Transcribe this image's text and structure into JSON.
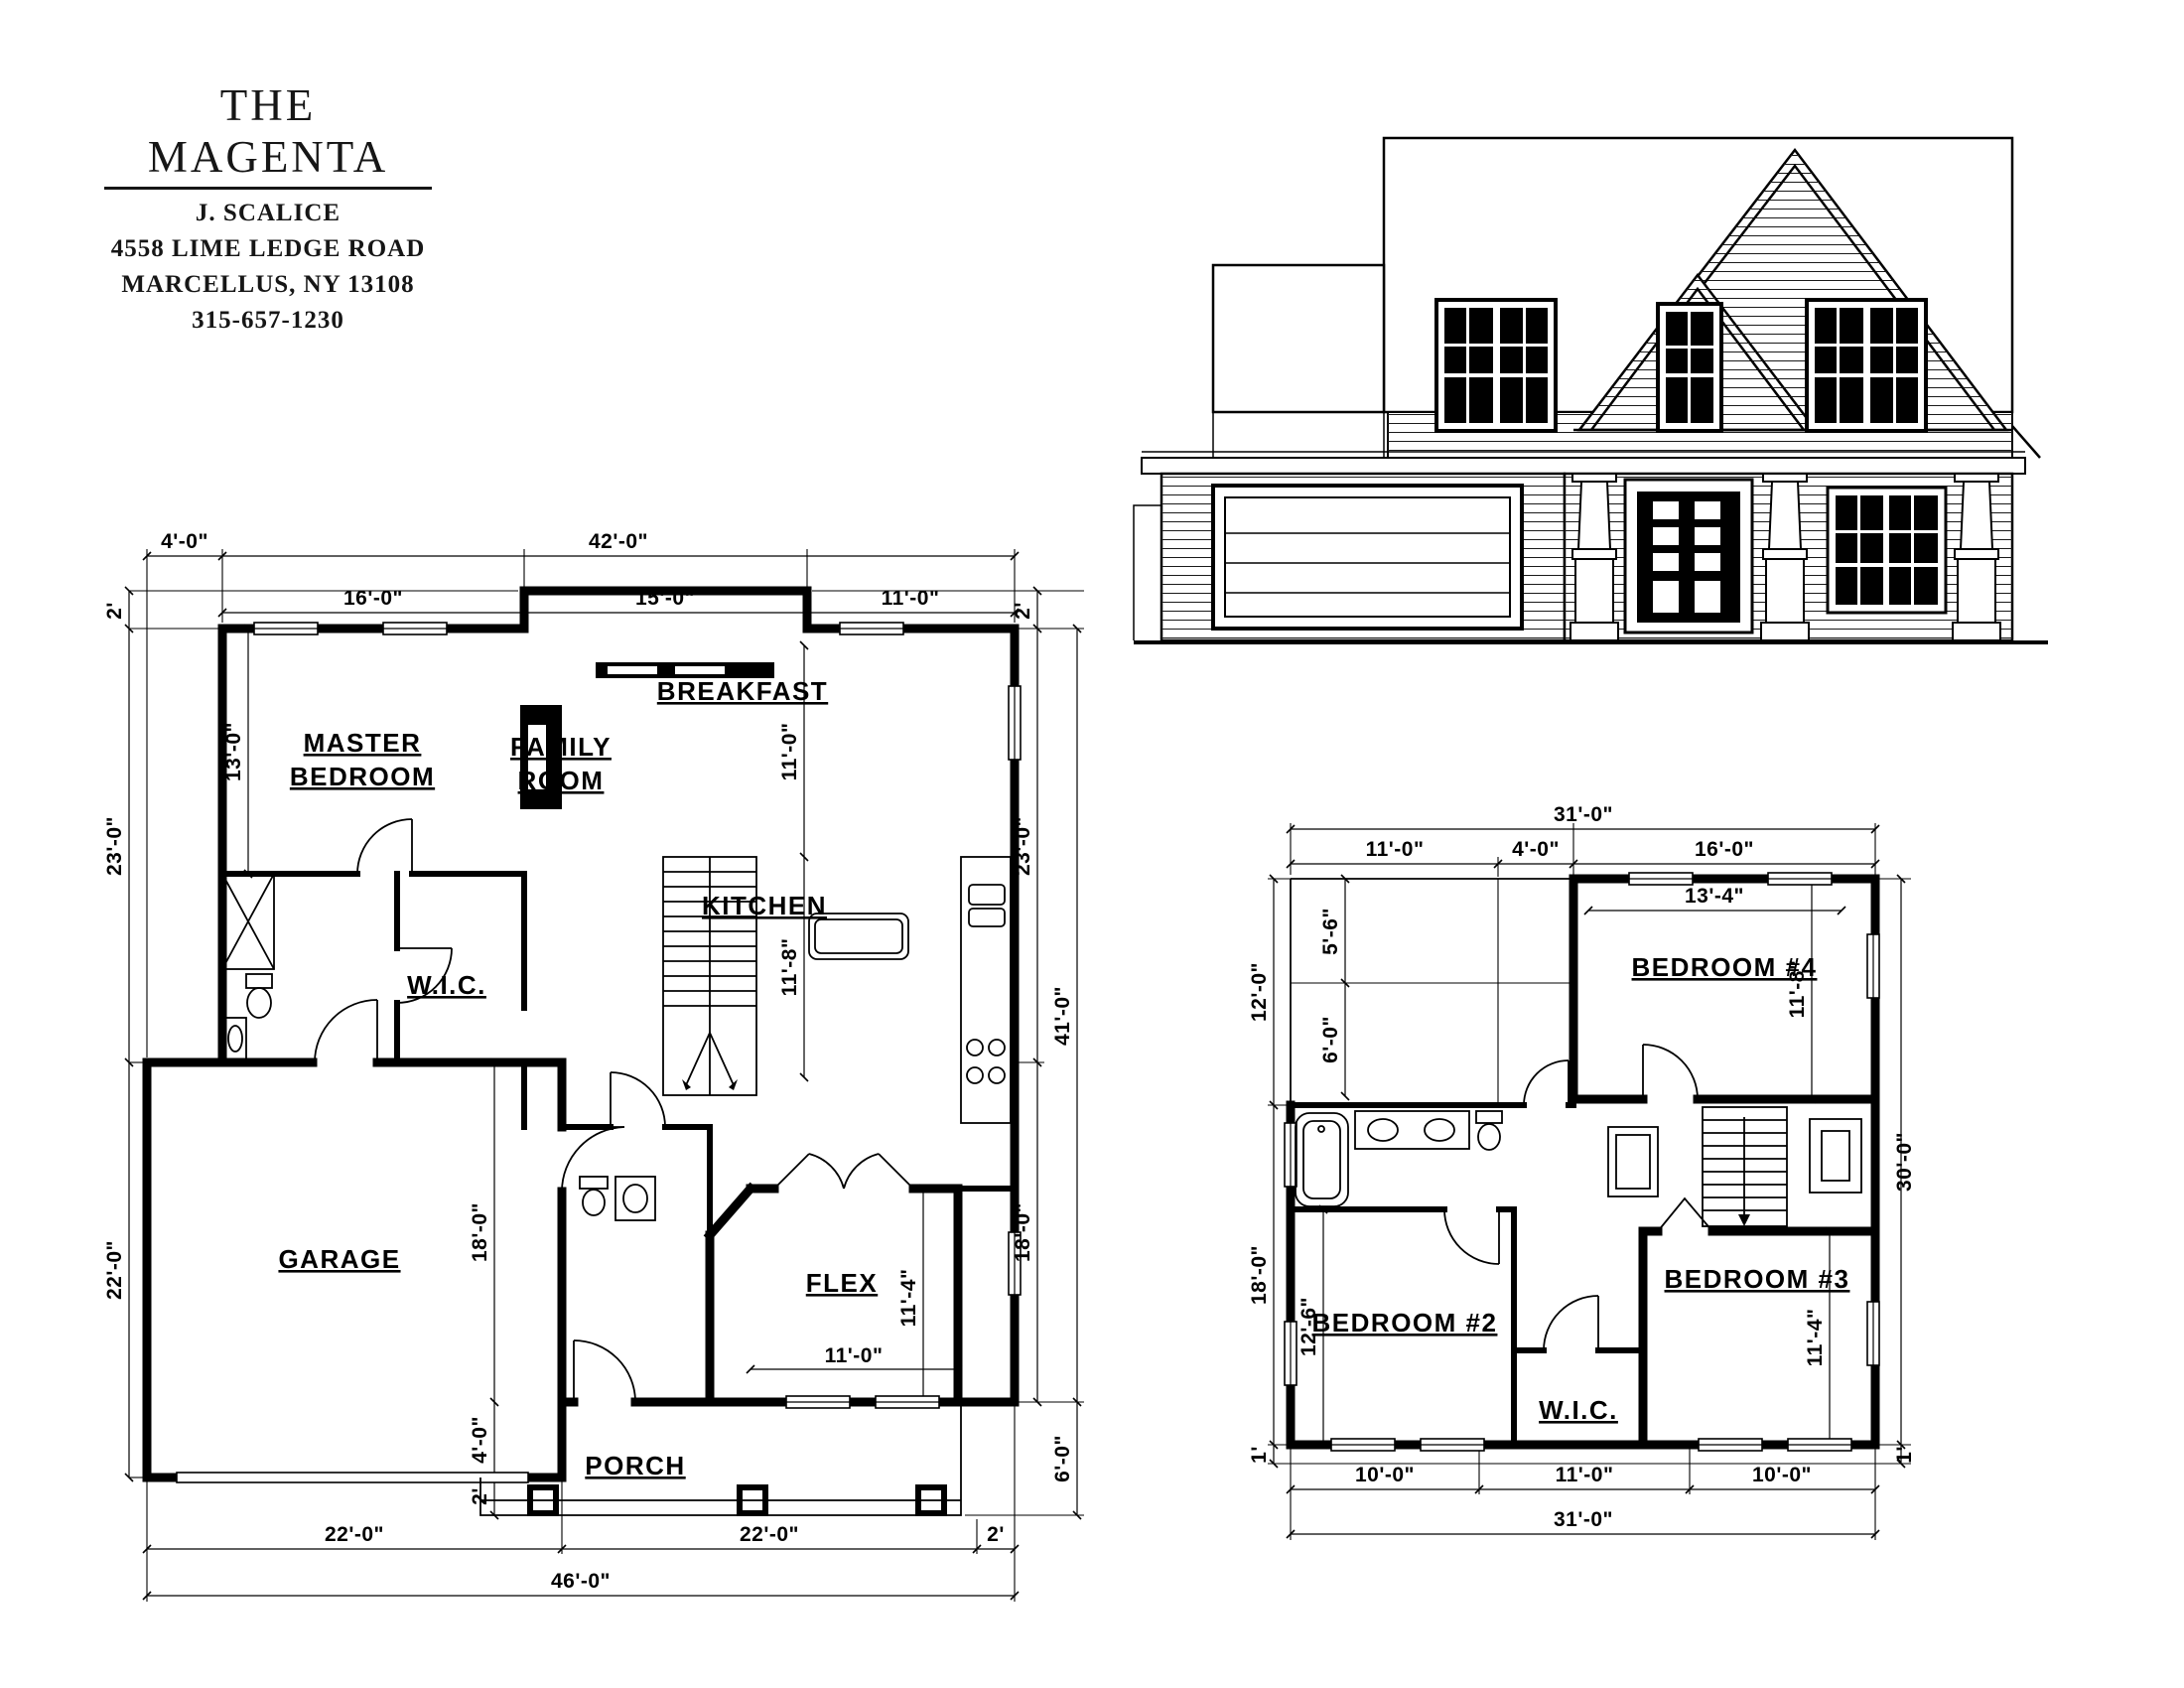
{
  "title_block": {
    "plan_name": "THE MAGENTA",
    "client_name": "J. SCALICE",
    "address": "4558 LIME LEDGE ROAD",
    "city_state_zip": "MARCELLUS, NY 13108",
    "phone": "315-657-1230"
  },
  "first_floor": {
    "rooms": {
      "master_line1": "MASTER",
      "master_line2": "BEDROOM",
      "family_line1": "FAMILY",
      "family_line2": "ROOM",
      "breakfast": "BREAKFAST",
      "kitchen": "KITCHEN",
      "wic": "W.I.C.",
      "garage": "GARAGE",
      "flex": "FLEX",
      "porch": "PORCH"
    },
    "dims": {
      "top_offset": "4'-0\"",
      "top_overall": "42'-0\"",
      "top_master": "16'-0\"",
      "top_family": "15'-0\"",
      "top_breakfast": "11'-0\"",
      "left_offset": "2'",
      "left_upper": "23'-0\"",
      "left_garage": "22'-0\"",
      "master_depth": "13'-0\"",
      "right_offset": "2'",
      "right_upper": "23'-0\"",
      "right_overall": "41'-0\"",
      "right_lower": "18'-0\"",
      "porch_depth": "6'-0\"",
      "breakfast_depth": "11'-0\"",
      "kitchen_depth": "11'-8\"",
      "hall_depth": "18'-0\"",
      "garage_offset": "4'-0\"",
      "porch_offset": "2'",
      "flex_depth": "11'-4\"",
      "flex_width": "11'-0\"",
      "bottom_garage": "22'-0\"",
      "bottom_main": "22'-0\"",
      "bottom_offset": "2'",
      "bottom_overall": "46'-0\""
    }
  },
  "second_floor": {
    "rooms": {
      "bedroom2": "BEDROOM #2",
      "bedroom3": "BEDROOM #3",
      "bedroom4": "BEDROOM #4",
      "wic": "W.I.C."
    },
    "dims": {
      "top_overall": "31'-0\"",
      "top_left": "11'-0\"",
      "top_mid": "4'-0\"",
      "top_right": "16'-0\"",
      "bed4_width": "13'-4\"",
      "bed4_depth": "11'-8\"",
      "left_upper": "12'-0\"",
      "left_lower": "18'-0\"",
      "left_inner_top": "5'-6\"",
      "left_inner_mid": "6'-0\"",
      "bed2_depth": "12'-6\"",
      "left_roof_offset": "1'",
      "right_overall": "30'-0\"",
      "bed3_depth": "11'-4\"",
      "right_roof_offset": "1'",
      "bottom_left": "10'-0\"",
      "bottom_mid": "11'-0\"",
      "bottom_right": "10'-0\"",
      "bottom_overall": "31'-0\""
    }
  }
}
